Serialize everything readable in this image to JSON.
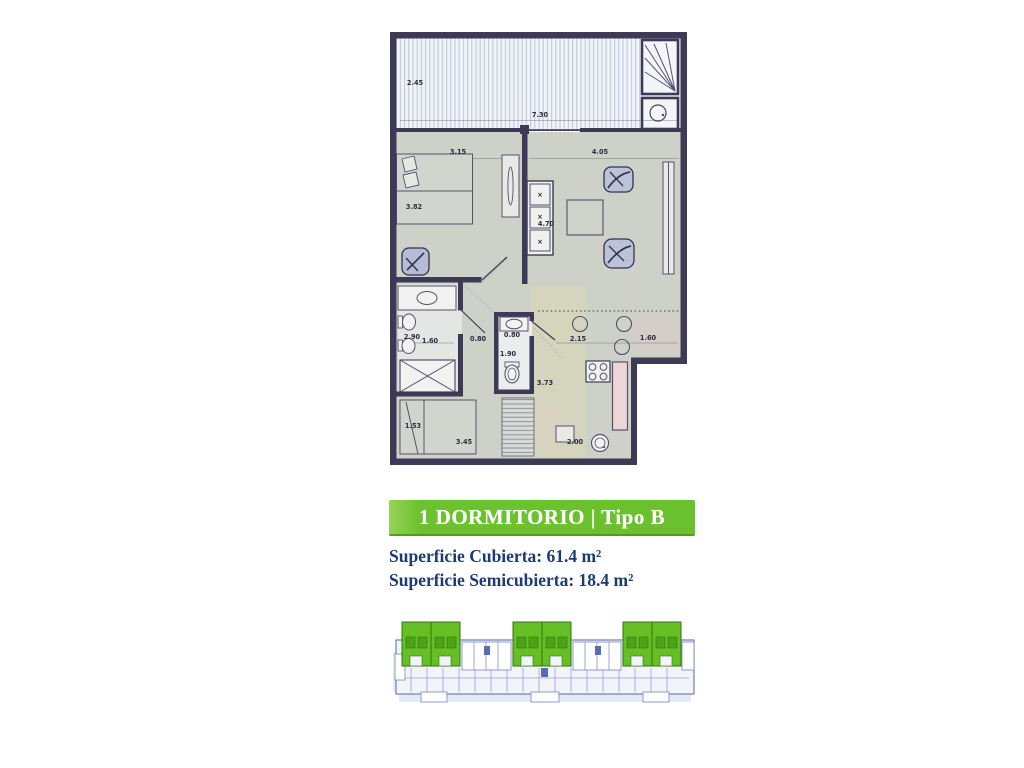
{
  "unit": {
    "type_label": "1 DORMITORIO | Tipo B",
    "area_covered": "Superficie Cubierta: 61.4 m²",
    "area_semicovered": "Superficie Semicubierta: 18.4 m²"
  },
  "colors": {
    "banner_green": "#6ac02d",
    "keyplan_highlight_green": "#65bf25",
    "area_text_navy": "#1c3a73",
    "plan_wall": "#3e3a55",
    "plan_floor": "#cdd1c8"
  },
  "floor_plan": {
    "dimension_labels": [
      {
        "text": "2.45",
        "x": 25,
        "y": 57
      },
      {
        "text": "7.30",
        "x": 150,
        "y": 89
      },
      {
        "text": "3.15",
        "x": 68,
        "y": 126
      },
      {
        "text": "4.05",
        "x": 210,
        "y": 126
      },
      {
        "text": "3.82",
        "x": 24,
        "y": 181
      },
      {
        "text": "4.70",
        "x": 156,
        "y": 198
      },
      {
        "text": "2.90",
        "x": 22,
        "y": 311
      },
      {
        "text": "1.60",
        "x": 40,
        "y": 315
      },
      {
        "text": "0.80",
        "x": 88,
        "y": 313
      },
      {
        "text": "0.80",
        "x": 122,
        "y": 309
      },
      {
        "text": "1.90",
        "x": 118,
        "y": 328
      },
      {
        "text": "2.15",
        "x": 188,
        "y": 313
      },
      {
        "text": "1.60",
        "x": 258,
        "y": 312
      },
      {
        "text": "3.73",
        "x": 155,
        "y": 357
      },
      {
        "text": "1.53",
        "x": 23,
        "y": 400
      },
      {
        "text": "3.45",
        "x": 74,
        "y": 416
      },
      {
        "text": "2.00",
        "x": 185,
        "y": 416
      }
    ]
  }
}
